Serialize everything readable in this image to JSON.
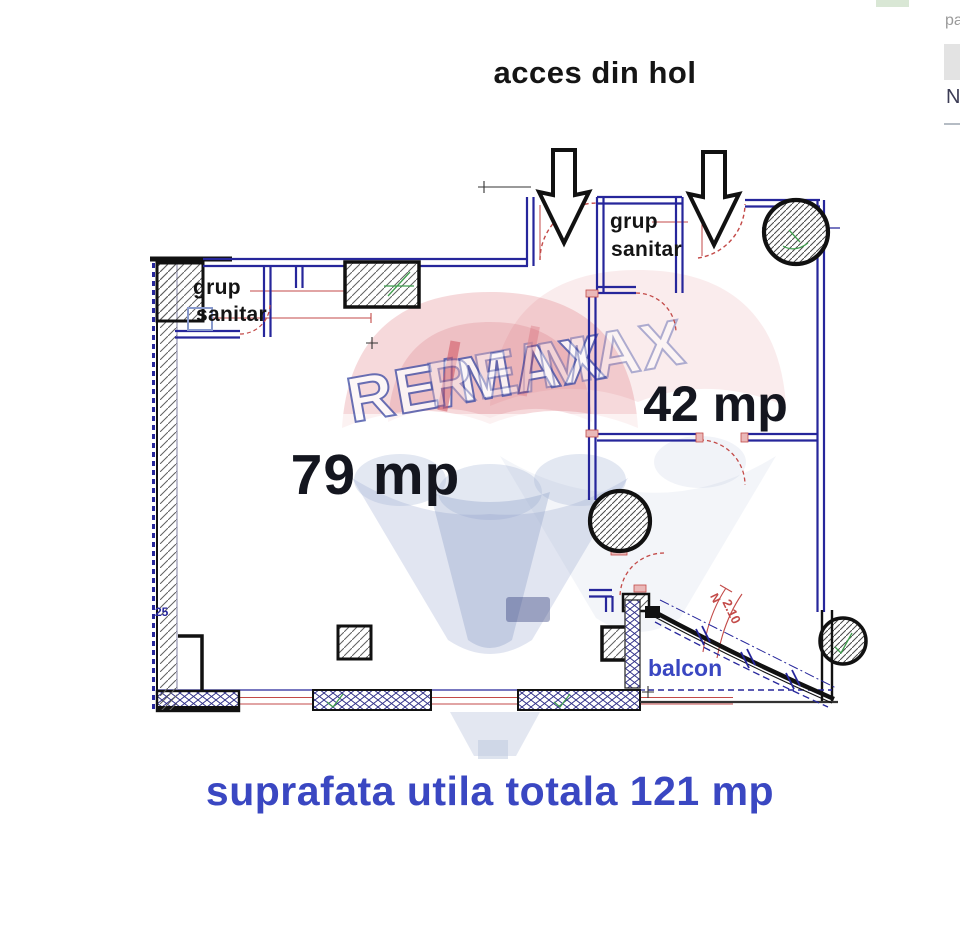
{
  "title": "acces din hol",
  "caption": "suprafata utila totala 121 mp",
  "watermark": {
    "text": "RE/MAX"
  },
  "plan": {
    "room_79": {
      "area": "79 mp"
    },
    "room_42": {
      "area": "42 mp"
    },
    "sanitar_left": {
      "line1": "grup",
      "line2": "sanitar"
    },
    "sanitar_top": {
      "line1": "grup",
      "line2": "sanitar"
    },
    "balcony": {
      "label": "balcon",
      "dim_prefix": "N",
      "dim": "2.10"
    },
    "left_wall_dim": "25",
    "colors": {
      "wall_navy": "#26269b",
      "dim_red": "#c34a48",
      "label_blue": "#3a47c2"
    }
  },
  "page_edge": {
    "partial_text_top": "pa",
    "partial_text_mid": "N"
  }
}
